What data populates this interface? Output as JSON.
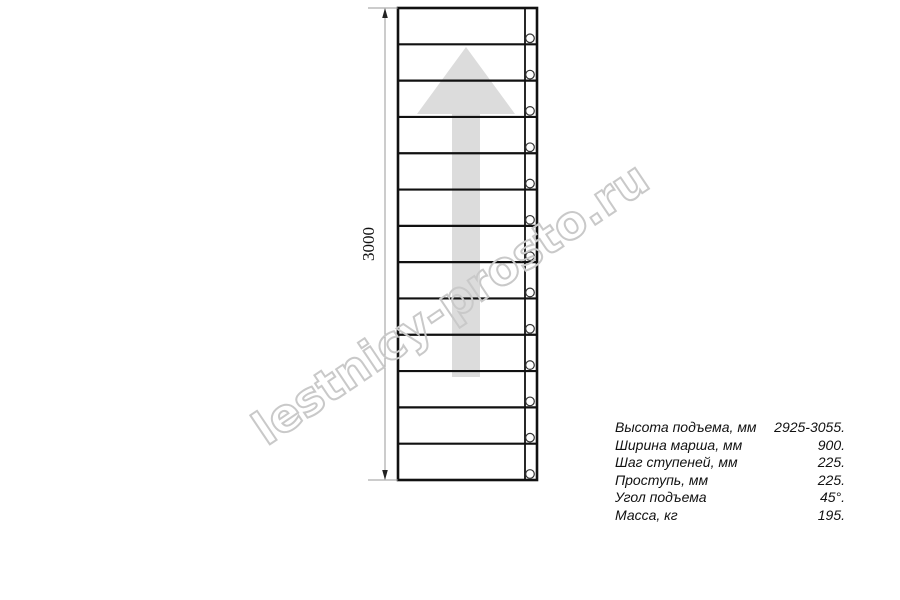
{
  "watermark": {
    "text": "lestnicy-prosto.ru",
    "color": "#c9c9c9",
    "center_x": 451,
    "center_y": 304,
    "rotation_deg": -34,
    "length_px": 465
  },
  "diagram": {
    "line_color": "#111111",
    "box": {
      "x": 398,
      "y": 8,
      "width": 139,
      "height": 472
    },
    "step_count": 13,
    "stringer_divider_x": 525,
    "bolt_circles": {
      "cx": 530,
      "r": 4.3,
      "offset_above_step": 6,
      "stroke": "#333333"
    },
    "direction_arrow": {
      "center_x": 466,
      "tip_y": 47,
      "head_base_y": 114,
      "head_width": 98,
      "tail_width": 28,
      "tail_bottom_y": 377,
      "color": "#dcdcdc"
    },
    "dimension_line": {
      "x": 385,
      "ext_x1": 368,
      "label": "3000",
      "label_x": 374,
      "label_y": 244,
      "line_color": "#999999",
      "arrow_color": "#222222"
    }
  },
  "specs": {
    "rows": [
      {
        "label": "Высота подъема, мм",
        "value": "2925-3055."
      },
      {
        "label": "Ширина марша, мм",
        "value": "900."
      },
      {
        "label": "Шаг ступеней, мм",
        "value": "225."
      },
      {
        "label": "Проступь, мм",
        "value": "225."
      },
      {
        "label": "Угол подъема",
        "value": "45°."
      },
      {
        "label": "Масса, кг",
        "value": "195."
      }
    ]
  }
}
